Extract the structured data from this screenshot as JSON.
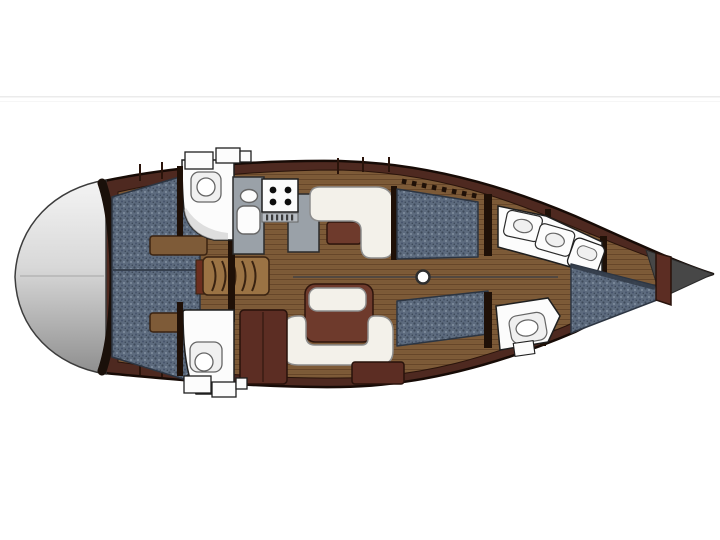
{
  "meta": {
    "width": 720,
    "height": 540,
    "kind": "sailing-yacht-interior-deck-plan"
  },
  "palette": {
    "bg": "#ffffff",
    "divider": "#ebebeb",
    "divider_soft": "#f6f6f6",
    "hull": "#4e2920",
    "hull_outline": "#170b06",
    "wood_base": "#7e5b38",
    "wood_grain": "#52351c",
    "step_wood": "#9b7344",
    "step_outline": "#3a2311",
    "step_side": "#6c2e1f",
    "upholstery": "#5d6b7e",
    "dot_dark": "#3e4a5a",
    "dot_mid": "#46536a",
    "dot_light": "#8b99a9",
    "upholstery_outline": "#2c3542",
    "upholstery_band": "#333c49",
    "fixture": "#fcfcfc",
    "fixture_outline": "#1f1f1f",
    "fixture_soft": "#f0f0f0",
    "fixture_soft_outline": "#666666",
    "counter": "#9aa1a8",
    "counter_outline": "#2b2b2b",
    "cushion": "#f3f1ea",
    "cushion_outline": "#8d8d8d",
    "table": "#6e3a2c",
    "table_outline": "#2e150c",
    "cabinet": "#5c2d23",
    "cabinet_outline": "#28120b",
    "bulkhead": "#1f1007",
    "transom_top": "#f4f4f4",
    "transom_mid": "#d8d8d8",
    "transom_bottom": "#8e8e8e",
    "transom_outline": "#3c3c3c",
    "transom_band": "#1a100a",
    "transom_seam": "#a6a6a6",
    "bow_cone": "#474747",
    "bow_cone_outline": "#2b2b2b",
    "burner": "#0e0e0e",
    "vent": "#b7bcc2",
    "vent_tick": "#3c3c3c",
    "centerline": "#3f4145",
    "mast": "#ffffff",
    "mast_outline": "#2f2f2f",
    "seam": "#2a140b",
    "shadow": "#c9c9c9"
  }
}
